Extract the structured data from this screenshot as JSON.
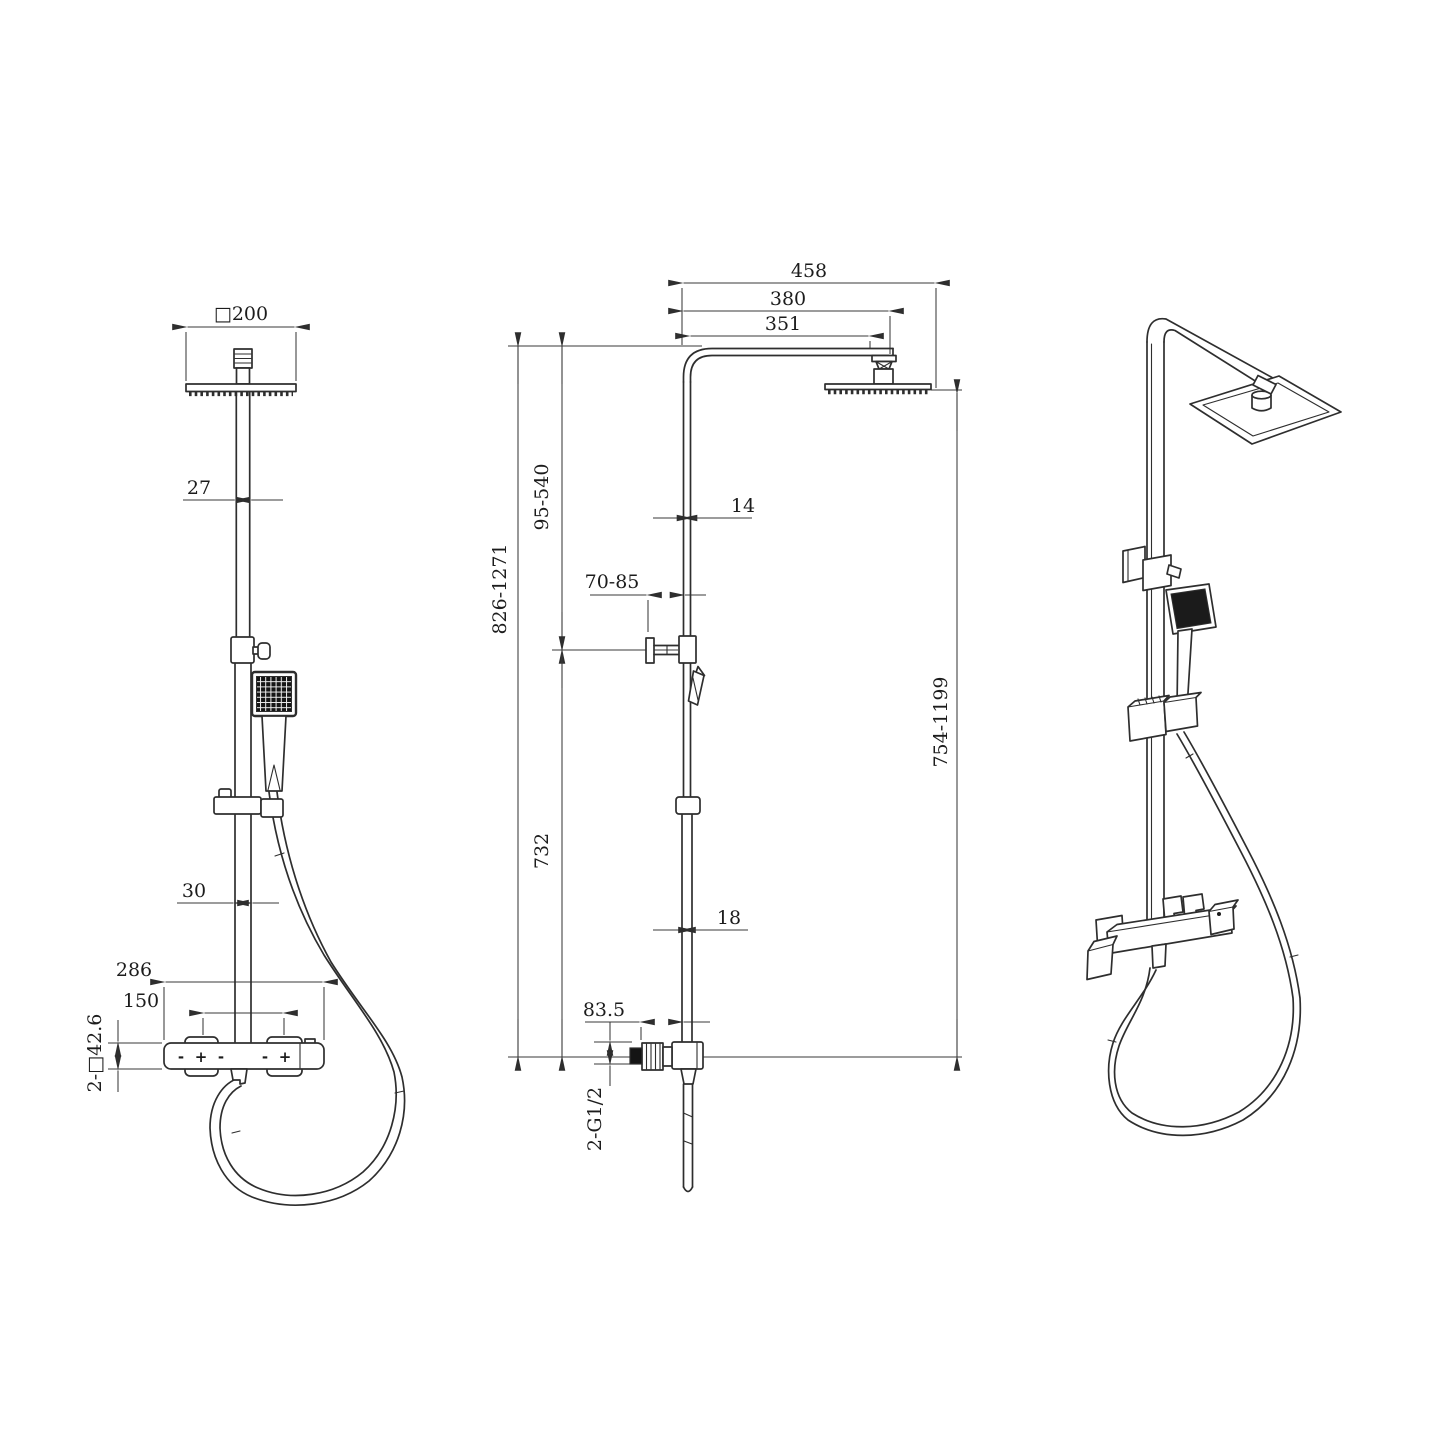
{
  "drawing": {
    "type": "technical-dimension-drawing",
    "subject": "thermostatic shower column with square rain head and hand shower",
    "views": [
      "front",
      "side",
      "perspective"
    ],
    "line_color": "#2e2e2e",
    "background": "#ffffff"
  },
  "dimensions": {
    "front": {
      "head_size": "□200",
      "upper_pipe": "27",
      "lower_pipe": "30",
      "valve_width": "286",
      "handle_spacing": "150",
      "escutcheons": "2-□42.6"
    },
    "side": {
      "arm_overall": "458",
      "arm_to_center": "380",
      "arm_length": "351",
      "head_to_bracket": "95-540",
      "overall_height": "826-1271",
      "bracket_to_valve": "732",
      "wall_offset": "70-85",
      "upper_pipe": "14",
      "lower_pipe": "18",
      "inlet_offset": "83.5",
      "riser_height": "754-1199",
      "inlet_thread": "2-G1/2"
    },
    "valve_markings": [
      "-",
      "+",
      "-",
      "-",
      "+"
    ]
  }
}
